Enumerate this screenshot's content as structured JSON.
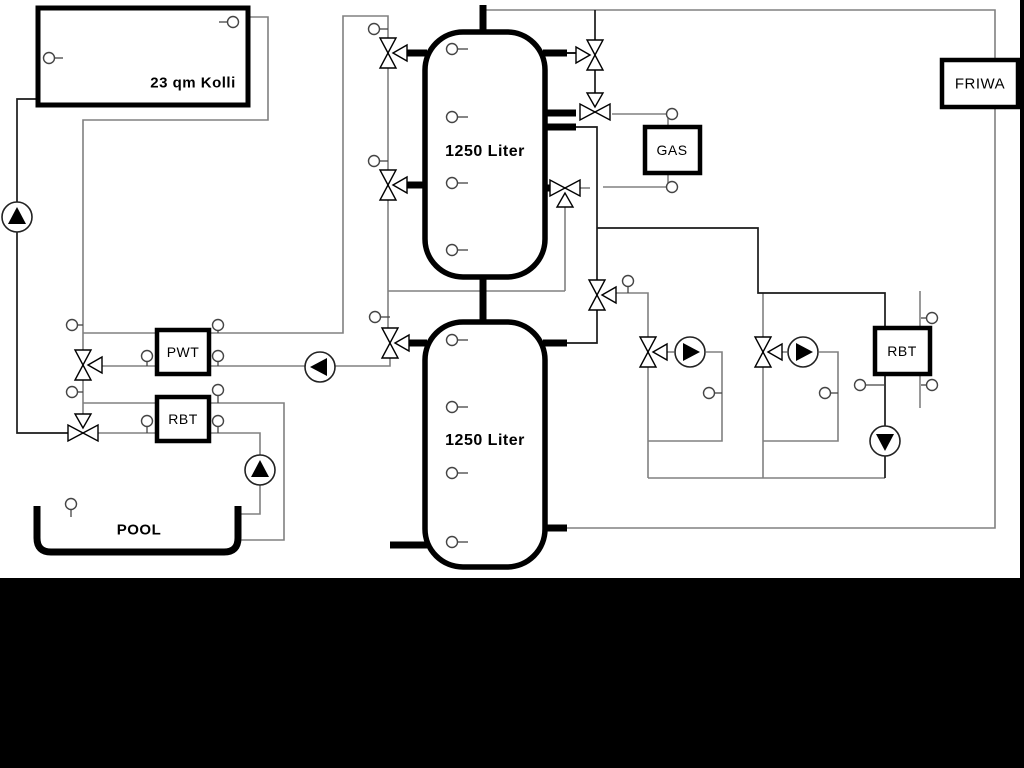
{
  "diagram": {
    "type": "heating-hydraulic-schematic",
    "boxes": {
      "collector": {
        "label": "23 qm Kolli"
      },
      "tank_top": {
        "label": "1250 Liter"
      },
      "tank_bottom": {
        "label": "1250 Liter"
      },
      "pwt": {
        "label": "PWT"
      },
      "rbt_left": {
        "label": "RBT"
      },
      "gas": {
        "label": "GAS"
      },
      "rbt_right": {
        "label": "RBT"
      },
      "friwa": {
        "label": "FRIWA"
      },
      "pool": {
        "label": "POOL"
      }
    },
    "colors": {
      "pipe_gray": "#808080",
      "pipe_black": "#1a1a1a",
      "footer_bar": "#000000",
      "background": "#ffffff"
    },
    "symbols": {
      "pump_count": 6,
      "three_way_valve_count": 11,
      "sensor_count": 25
    }
  }
}
